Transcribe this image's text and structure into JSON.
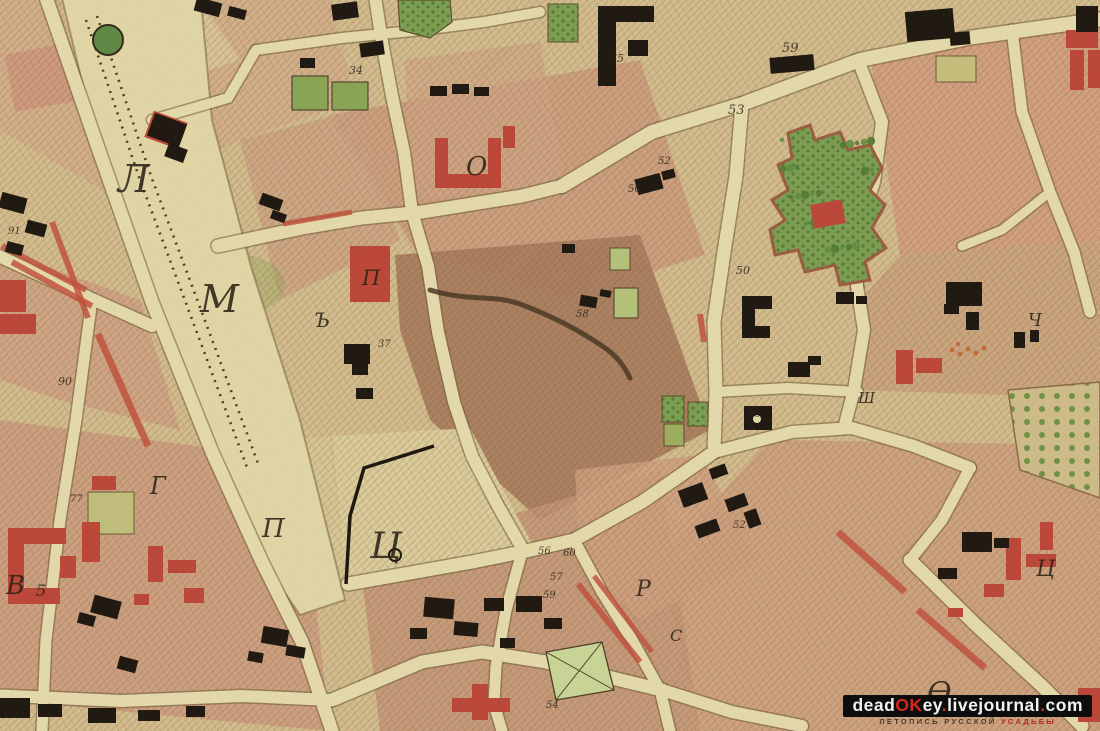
{
  "map": {
    "type": "historical-city-plan-scan",
    "labels": [
      {
        "text": "Л",
        "x": 118,
        "y": 192,
        "size": 38,
        "kind": "district-letter"
      },
      {
        "text": "М",
        "x": 200,
        "y": 312,
        "size": 38,
        "kind": "district-letter"
      },
      {
        "text": "О",
        "x": 466,
        "y": 175,
        "size": 26,
        "kind": "district-letter"
      },
      {
        "text": "П",
        "x": 362,
        "y": 285,
        "size": 21,
        "kind": "district-letter"
      },
      {
        "text": "Ъ",
        "x": 314,
        "y": 327,
        "size": 20,
        "kind": "district-letter"
      },
      {
        "text": "Ц",
        "x": 370,
        "y": 558,
        "size": 36,
        "kind": "district-letter"
      },
      {
        "text": "П",
        "x": 262,
        "y": 537,
        "size": 26,
        "kind": "district-letter"
      },
      {
        "text": "Г",
        "x": 150,
        "y": 494,
        "size": 24,
        "kind": "district-letter"
      },
      {
        "text": "В",
        "x": 6,
        "y": 594,
        "size": 26,
        "kind": "district-letter"
      },
      {
        "text": "Р",
        "x": 636,
        "y": 596,
        "size": 22,
        "kind": "district-letter"
      },
      {
        "text": "С",
        "x": 670,
        "y": 641,
        "size": 16,
        "kind": "district-letter"
      },
      {
        "text": "Ч",
        "x": 1028,
        "y": 326,
        "size": 18,
        "kind": "district-letter"
      },
      {
        "text": "Ш",
        "x": 858,
        "y": 403,
        "size": 15,
        "kind": "district-letter"
      },
      {
        "text": "Ц",
        "x": 1036,
        "y": 576,
        "size": 22,
        "kind": "district-letter"
      },
      {
        "text": "Ѳ",
        "x": 927,
        "y": 703,
        "size": 30,
        "kind": "district-letter"
      },
      {
        "text": "34",
        "x": 349,
        "y": 74,
        "size": 11,
        "kind": "plot-number"
      },
      {
        "text": "59",
        "x": 782,
        "y": 52,
        "size": 13,
        "kind": "plot-number"
      },
      {
        "text": "65",
        "x": 610,
        "y": 62,
        "size": 11,
        "kind": "plot-number"
      },
      {
        "text": "53",
        "x": 728,
        "y": 114,
        "size": 13,
        "kind": "plot-number"
      },
      {
        "text": "52",
        "x": 658,
        "y": 164,
        "size": 10,
        "kind": "plot-number"
      },
      {
        "text": "56",
        "x": 628,
        "y": 192,
        "size": 10,
        "kind": "plot-number"
      },
      {
        "text": "50",
        "x": 736,
        "y": 274,
        "size": 11,
        "kind": "plot-number"
      },
      {
        "text": "37",
        "x": 378,
        "y": 347,
        "size": 10,
        "kind": "plot-number"
      },
      {
        "text": "58",
        "x": 576,
        "y": 317,
        "size": 10,
        "kind": "plot-number"
      },
      {
        "text": "90",
        "x": 58,
        "y": 385,
        "size": 11,
        "kind": "plot-number"
      },
      {
        "text": "91",
        "x": 8,
        "y": 234,
        "size": 10,
        "kind": "plot-number"
      },
      {
        "text": "46",
        "x": 748,
        "y": 417,
        "size": 10,
        "kind": "plot-number"
      },
      {
        "text": "52",
        "x": 733,
        "y": 528,
        "size": 10,
        "kind": "plot-number"
      },
      {
        "text": "56",
        "x": 538,
        "y": 554,
        "size": 10,
        "kind": "plot-number"
      },
      {
        "text": "60",
        "x": 563,
        "y": 556,
        "size": 10,
        "kind": "plot-number"
      },
      {
        "text": "57",
        "x": 550,
        "y": 580,
        "size": 10,
        "kind": "plot-number"
      },
      {
        "text": "59",
        "x": 543,
        "y": 598,
        "size": 10,
        "kind": "plot-number"
      },
      {
        "text": "77",
        "x": 70,
        "y": 502,
        "size": 10,
        "kind": "plot-number"
      },
      {
        "text": "5",
        "x": 36,
        "y": 596,
        "size": 16,
        "kind": "plot-number"
      },
      {
        "text": "54",
        "x": 546,
        "y": 708,
        "size": 10,
        "kind": "plot-number"
      }
    ],
    "palette": {
      "parchment": "#d7c291",
      "road": "#eae0b0",
      "field_pink": "#cf9d7e",
      "field_brown": "#ab7f60",
      "building_black": "#17120c",
      "building_red": "#bf4436",
      "garden_green": "#7ba052",
      "ink": "#241c12",
      "red_accent": "#c03a2b"
    }
  },
  "watermark": {
    "segments": [
      {
        "text": "dead",
        "color": "#f2f2f2"
      },
      {
        "text": "OK",
        "color": "#d42a1e"
      },
      {
        "text": "ey",
        "color": "#f2f2f2"
      },
      {
        "text": ".",
        "color": "#d42a1e"
      },
      {
        "text": "livejournal",
        "color": "#f2f2f2"
      },
      {
        "text": ".",
        "color": "#d42a1e"
      },
      {
        "text": "com",
        "color": "#f2f2f2"
      }
    ],
    "tagline": [
      {
        "text": "ЛЕТОПИСЬ РУССКОЙ ",
        "color": "#4a3a28"
      },
      {
        "text": "УСАДЬБЫ",
        "color": "#b5281e"
      }
    ]
  }
}
